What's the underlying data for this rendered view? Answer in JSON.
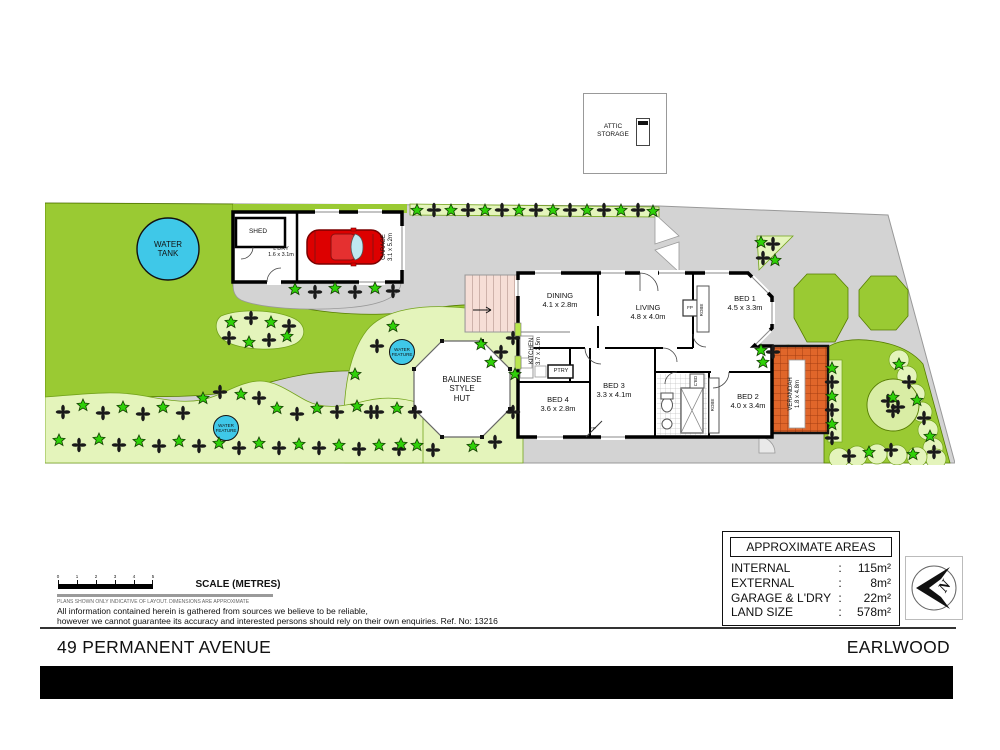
{
  "title": {
    "address": "49 PERMANENT AVENUE",
    "suburb": "EARLWOOD"
  },
  "attic": {
    "label": "ATTIC\nSTORAGE"
  },
  "site": {
    "water_tank": "WATER\nTANK",
    "water_feature": "WATER\nFEATURE",
    "balinese_hut": "BALINESE\nSTYLE\nHUT",
    "shed": "SHED",
    "ldry": "L'DRY\n1.6 x 3.1m",
    "garage": "GARAGE\n3.1 x 5.2m"
  },
  "rooms": {
    "dining": "DINING\n4.1 x 2.8m",
    "living": "LIVING\n4.8 x 4.0m",
    "bed1": "BED 1\n4.5 x 3.3m",
    "bed2": "BED 2\n4.0 x 3.4m",
    "bed3": "BED 3\n3.3 x 4.1m",
    "bed4": "BED 4\n3.6 x 2.8m",
    "kitchen": "KITCHEN\n3.7 x 2.5m",
    "verandah": "VERANDAH\n1.8 x 4.8m",
    "pantry": "PTRY",
    "fireplace": "FP",
    "robe": "ROBE",
    "cupboard": "C'BD"
  },
  "scale": {
    "label": "SCALE (METRES)",
    "ticks": [
      "0",
      "1",
      "2",
      "3",
      "4",
      "5"
    ]
  },
  "disclaimer": {
    "tiny": "PLANS SHOWN ONLY INDICATIVE OF LAYOUT. DIMENSIONS ARE APPROXIMATE",
    "line1": "All information contained herein is gathered from sources we believe to be reliable,",
    "line2": "however we cannot guarantee its accuracy and interested persons should rely on their own enquiries. Ref. No: 13216"
  },
  "areas": {
    "title": "APPROXIMATE AREAS",
    "rows": [
      {
        "label": "INTERNAL",
        "colon": ":",
        "value": "115m²"
      },
      {
        "label": "EXTERNAL",
        "colon": ":",
        "value": "8m²"
      },
      {
        "label": "GARAGE & L'DRY",
        "colon": ":",
        "value": "22m²"
      },
      {
        "label": "LAND SIZE",
        "colon": ":",
        "value": "578m²"
      }
    ]
  },
  "compass": {
    "letter": "N"
  },
  "colors": {
    "lawn": "#9aca33",
    "garden_bed": "#e4f4bb",
    "water": "#3fc8e8",
    "driveway": "#d3d3d3",
    "veranda_tile": "#e0662a",
    "car": "#dd0000",
    "walls": "#000000"
  }
}
